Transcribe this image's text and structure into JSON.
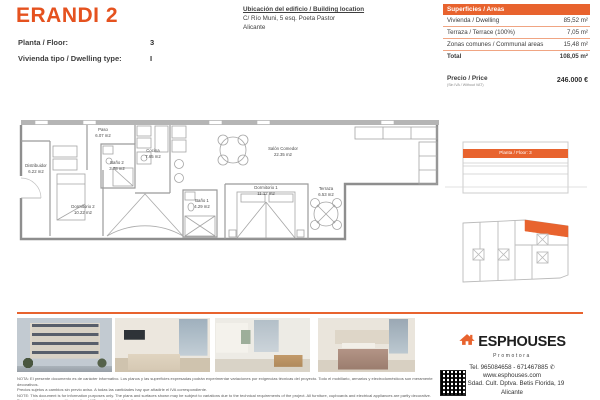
{
  "header": {
    "title": "ERANDI 2",
    "floor_label": "Planta / Floor:",
    "floor_value": "3",
    "type_label": "Vivienda tipo / Dwelling type:",
    "type_value": "I",
    "location_title": "Ubicación del edificio / Building location",
    "location_line1": "C/ Río Muni, 5 esq. Poeta Pastor",
    "location_line2": "Alicante"
  },
  "areas": {
    "header": "Superficies / Areas",
    "rows": [
      {
        "label": "Vivienda / Dwelling",
        "value": "85,52 m²"
      },
      {
        "label": "Terraza / Terrace (100%)",
        "value": "7,05 m²"
      },
      {
        "label": "Zonas comunes / Communal areas",
        "value": "15,48 m²"
      }
    ],
    "total_label": "Total",
    "total_value": "108,05 m²"
  },
  "price": {
    "label": "Precio / Price",
    "sublabel": "(Sin IVA / Without VAT)",
    "value": "246.000 €"
  },
  "floorplan": {
    "rooms": [
      {
        "name": "Distribuidor",
        "area": "6.22 m2"
      },
      {
        "name": "Paso",
        "area": "6.07 m2"
      },
      {
        "name": "Baño 2",
        "area": "3.78 m2"
      },
      {
        "name": "Cocina",
        "area": "7.65 m2"
      },
      {
        "name": "Dormitorio 2",
        "area": "10.22 m2"
      },
      {
        "name": "Salón Comedor",
        "area": "22.35 m2"
      },
      {
        "name": "Baño 1",
        "area": "4.29 m2"
      },
      {
        "name": "Dormitorio 1",
        "area": "11.12 m2"
      },
      {
        "name": "Terraza",
        "area": "6.53 m2"
      }
    ]
  },
  "elevation": {
    "label": "Planta / Floor: 3"
  },
  "footer": {
    "brand": "ESPHOUSES",
    "brand_sub": "Promotora",
    "phone_icon": "✆",
    "tel": "Tel. 965084658 - 671467885",
    "web": "www.esphouses.com",
    "address": "C/ Sdad. Cult. Dptva. Betis Florida, 19",
    "city": "Alicante",
    "disclaimer_es1": "NOTA: El presente documento es de carácter informativo. Los planos y las superficies expresadas podrán experimentar variaciones por exigencias técnicas del proyecto. Todo el mobiliario, armarios y electrodomésticos son meramente decorativos.",
    "disclaimer_es2": "Precios sujetos a cambios sin previo aviso. A todas las cantidades hay que añadirle el IVA correspondiente.",
    "disclaimer_en1": "NOTE: This document is for information purposes only. The plans and surfaces shown may be subject to variations due to the technical requirements of the project. All furniture, cupboards and electrical appliances are partly decorative.",
    "disclaimer_en2": "Prices subject to change without notice. VAT must be added to all amounts."
  }
}
